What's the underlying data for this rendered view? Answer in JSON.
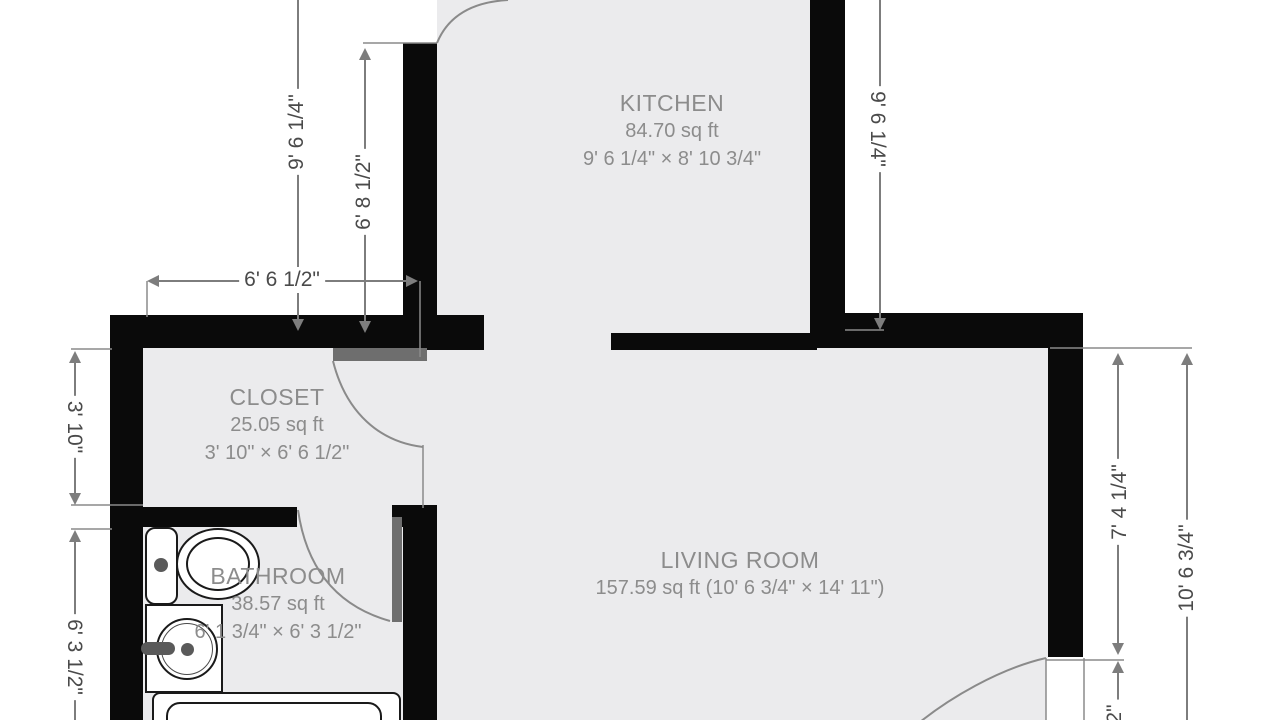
{
  "colors": {
    "wall": "#0a0a0a",
    "floor": "#ebebed",
    "door": "#6e6e6e",
    "line": "#7d7d7d",
    "dim_text": "#4a4a4a",
    "room_text": "#8c8c8c",
    "background": "#ffffff",
    "fixture_outline": "#1a1a1a"
  },
  "rooms": {
    "kitchen": {
      "name": "KITCHEN",
      "area": "84.70 sq ft",
      "size": "9' 6 1/4\" × 8' 10 3/4\""
    },
    "closet": {
      "name": "CLOSET",
      "area": "25.05 sq ft",
      "size": "3' 10\" × 6' 6 1/2\""
    },
    "bathroom": {
      "name": "BATHROOM",
      "area": "38.57 sq ft",
      "size": "6' 1 3/4\" × 6' 3 1/2\""
    },
    "living_room": {
      "name": "LIVING ROOM",
      "stats": "157.59 sq ft (10' 6 3/4\" × 14' 11\")"
    }
  },
  "dimensions": {
    "kitchen_height_left": "9' 6 1/4\"",
    "kitchen_inner_height": "6' 8 1/2\"",
    "closet_width": "6' 6 1/2\"",
    "closet_depth": "3' 10\"",
    "bathroom_depth": "6' 3 1/2\"",
    "kitchen_height_right": "9' 6 1/4\"",
    "living_wall_segment": "7' 4 1/4\"",
    "living_depth": "10' 6 3/4\"",
    "bottom_right_partial": "2\""
  },
  "fixtures": [
    "toilet",
    "sink",
    "bathtub"
  ]
}
